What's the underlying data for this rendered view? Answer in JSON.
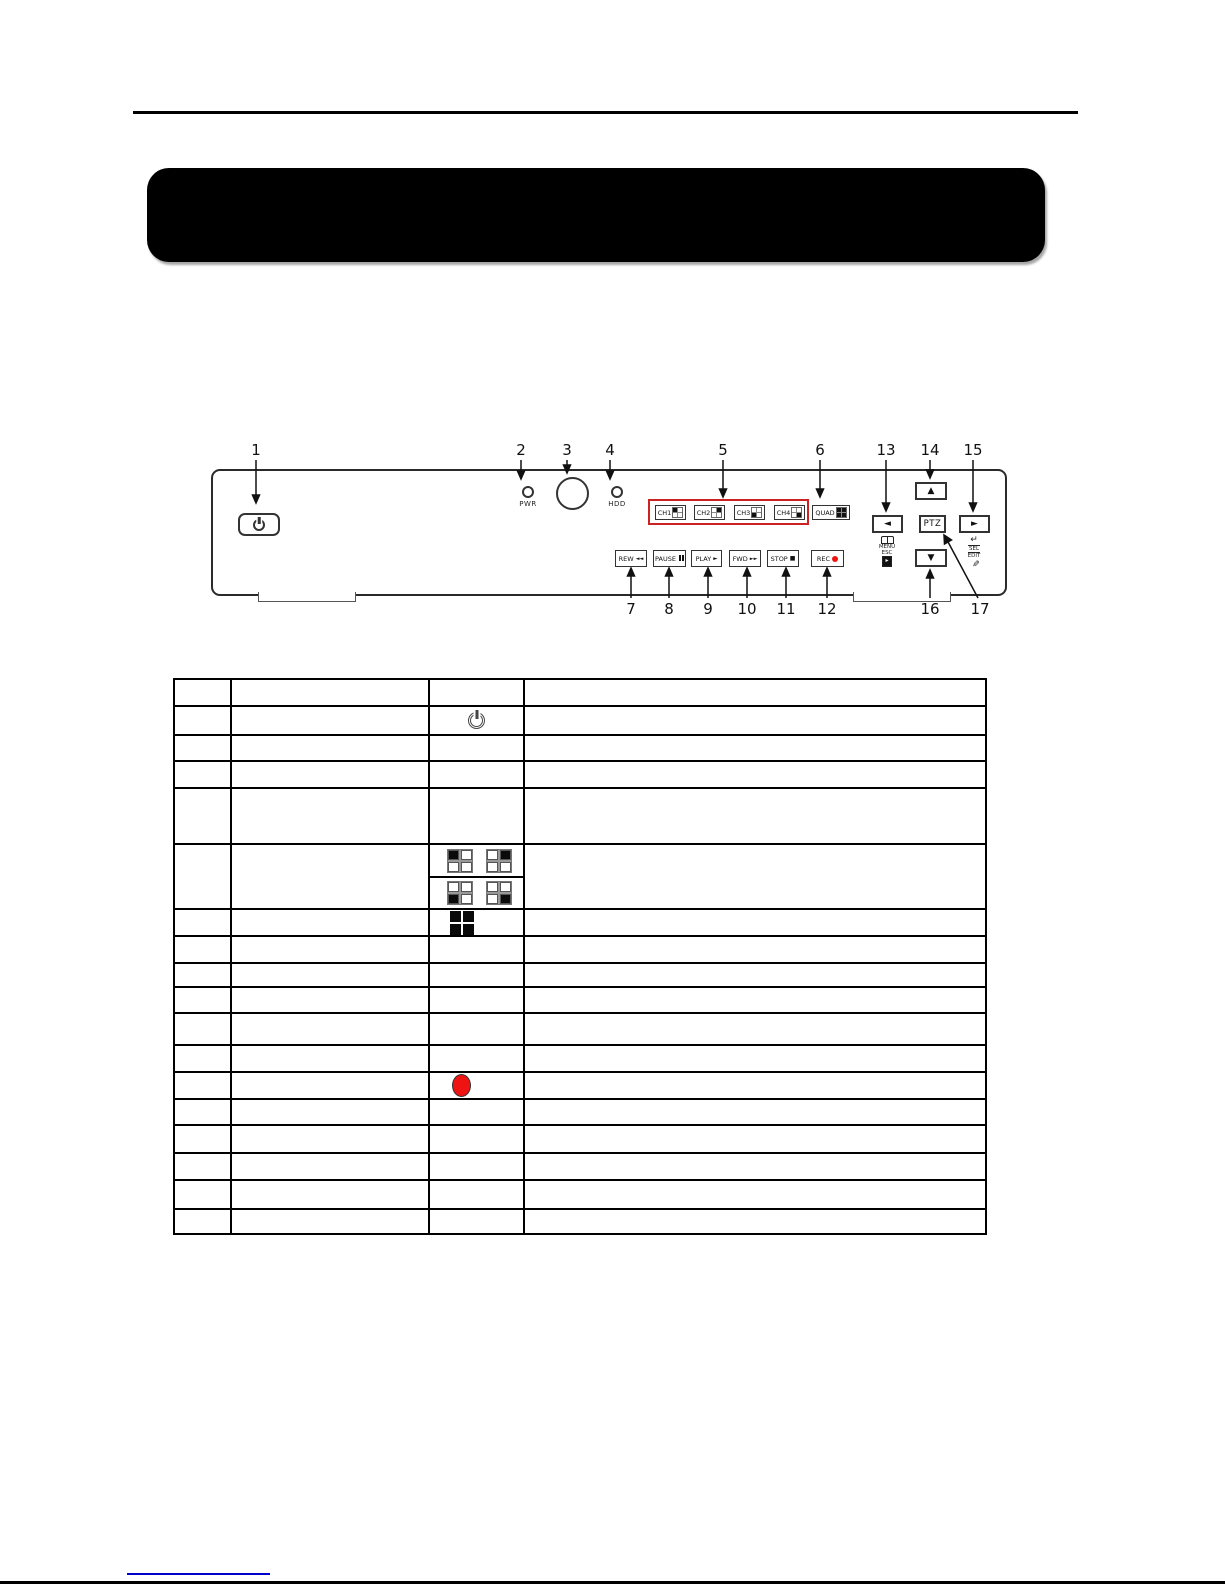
{
  "banner": {
    "text": ""
  },
  "colors": {
    "banner": "#000000",
    "highlight_frame": "#cc2222",
    "record_red": "#ee1414",
    "link_blue": "#0000cc"
  },
  "diagram": {
    "callouts": {
      "n1": "1",
      "n2": "2",
      "n3": "3",
      "n4": "4",
      "n5": "5",
      "n6": "6",
      "n7": "7",
      "n8": "8",
      "n9": "9",
      "n10": "10",
      "n11": "11",
      "n12": "12",
      "n13": "13",
      "n14": "14",
      "n15": "15",
      "n16": "16",
      "n17": "17"
    },
    "leds": {
      "pwr": "PWR",
      "hdd": "HDD"
    },
    "buttons": {
      "channels": [
        "CH1",
        "CH2",
        "CH3",
        "CH4"
      ],
      "quad": "QUAD",
      "rew": "REW",
      "rew_glyph": "◄◄",
      "pause": "PAUSE",
      "play": "PLAY",
      "play_glyph": "►",
      "fwd": "FWD",
      "fwd_glyph": "►►",
      "stop": "STOP",
      "stop_glyph": "■",
      "rec": "REC",
      "ptz": "PTZ",
      "up": "▲",
      "down": "▼",
      "left": "◄",
      "right": "►"
    },
    "sublabels": {
      "menu": "MENU",
      "esc": "ESC",
      "enter": "↵",
      "sel": "SEL",
      "edit": "EDIT",
      "pencil": "✎"
    }
  },
  "table": {
    "row_count": 18,
    "column_count": 4,
    "icons": {
      "row1": "power-icon",
      "row5": [
        "quad-top-left",
        "quad-top-right",
        "quad-bottom-left",
        "quad-bottom-right"
      ],
      "row6": "quad-all-icon",
      "row12": "record-dot"
    }
  }
}
